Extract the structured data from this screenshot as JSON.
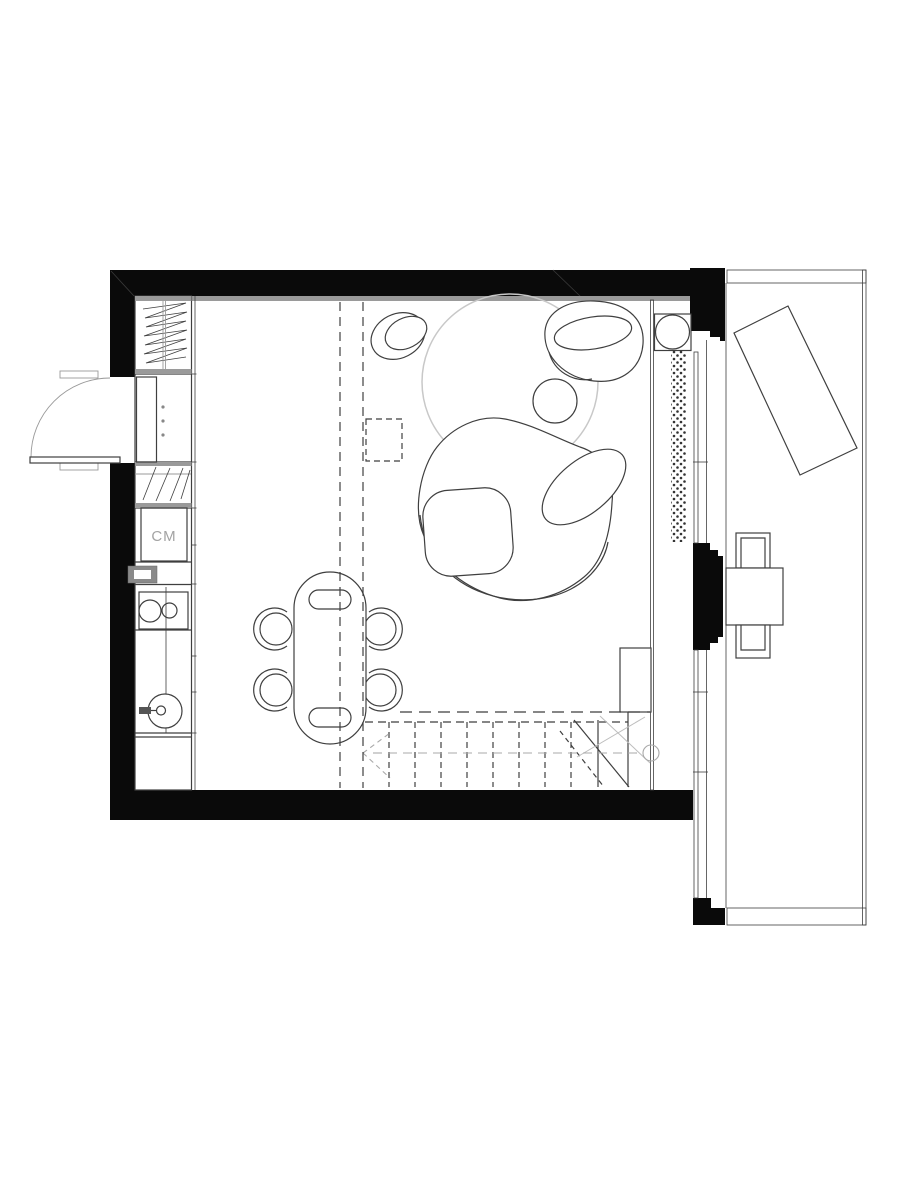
{
  "labels": {
    "washing_machine": "CM"
  },
  "colors": {
    "background": "#ffffff",
    "wall": "#0a0a0a",
    "line": "#3f3f3f",
    "gray_band": "#9a9a9a",
    "light_gray": "#c8c8c8",
    "stairs_gray": "#a8a8a8",
    "label_gray": "#a3a3a3"
  },
  "legend": {
    "drawing": "apartment-floor-plan",
    "icons": [
      "wardrobe-hanging-icon",
      "entry-door-swing-icon",
      "shoe-cabinet-icon",
      "washing-machine-icon",
      "cooktop-two-burner-icon",
      "kitchen-sink-icon",
      "dining-table-icon",
      "dining-chair-icon",
      "rug-icon",
      "sofa-icon",
      "armchair-icon",
      "pouf-icon",
      "side-table-icon",
      "stairs-icon",
      "stair-direction-arrow-icon",
      "column-stove-icon",
      "radiator-dots-icon",
      "void-dashed-line-icon",
      "balcony-icon",
      "sun-lounger-icon",
      "balcony-table-icon",
      "balcony-chair-icon"
    ]
  }
}
